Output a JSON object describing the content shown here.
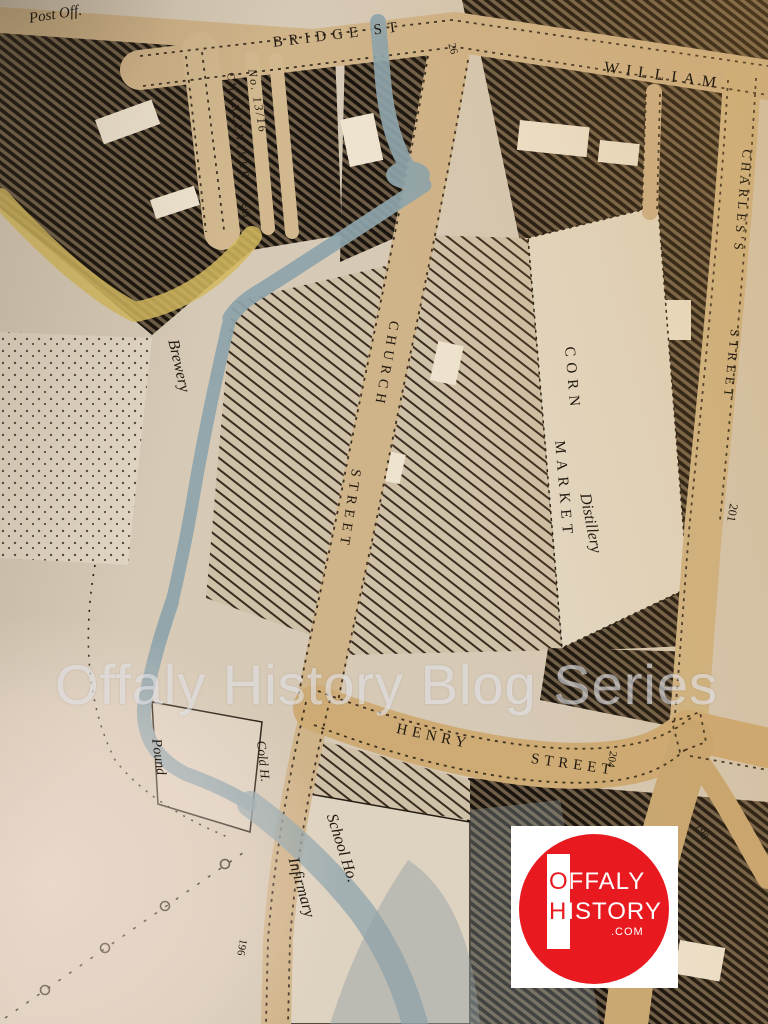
{
  "map": {
    "labels": {
      "post_office": "Post Off.",
      "bridge_st": "BRIDGE ST",
      "william_st": "WILLIAM",
      "plot_26": "26",
      "charleville": "CHARLEVILLE",
      "charleville_sq": "SQ",
      "plot_13_16": "No. 13/16",
      "charless": "CHARLES'S",
      "charless_street_word": "STREET",
      "plot_201": "201",
      "church": "CHURCH",
      "church_street_word": "STREET",
      "corn": "CORN",
      "market": "MARKET",
      "distillery": "Distillery",
      "brewery": "Brewery",
      "brewery_edge": "Brewery",
      "henry": "HENRY",
      "henry_street_word": "STREET",
      "plot_204": "204",
      "plot_198": "198",
      "pound": "Pound",
      "cold_harbour": "Cold H.",
      "school_house": "School Ho.",
      "infirmary": "Infirmary",
      "plot_196": "196"
    },
    "colors": {
      "paper": "#d6c9b5",
      "street_tan": "#cfb389",
      "street_orange": "#ceab75",
      "yellow_road": "#d4b95e",
      "water": "#8da4ab",
      "ink": "#19130d",
      "plaza": "#e3d8c4",
      "logo_red": "#e81a20",
      "logo_white": "#ffffff"
    }
  },
  "watermark": {
    "text": "Offaly History Blog Series"
  },
  "logo": {
    "line1_first": "O",
    "line1_rest": "FFALY",
    "line2_first": "H",
    "line2_rest": "ISTORY",
    "domain": ".COM"
  }
}
